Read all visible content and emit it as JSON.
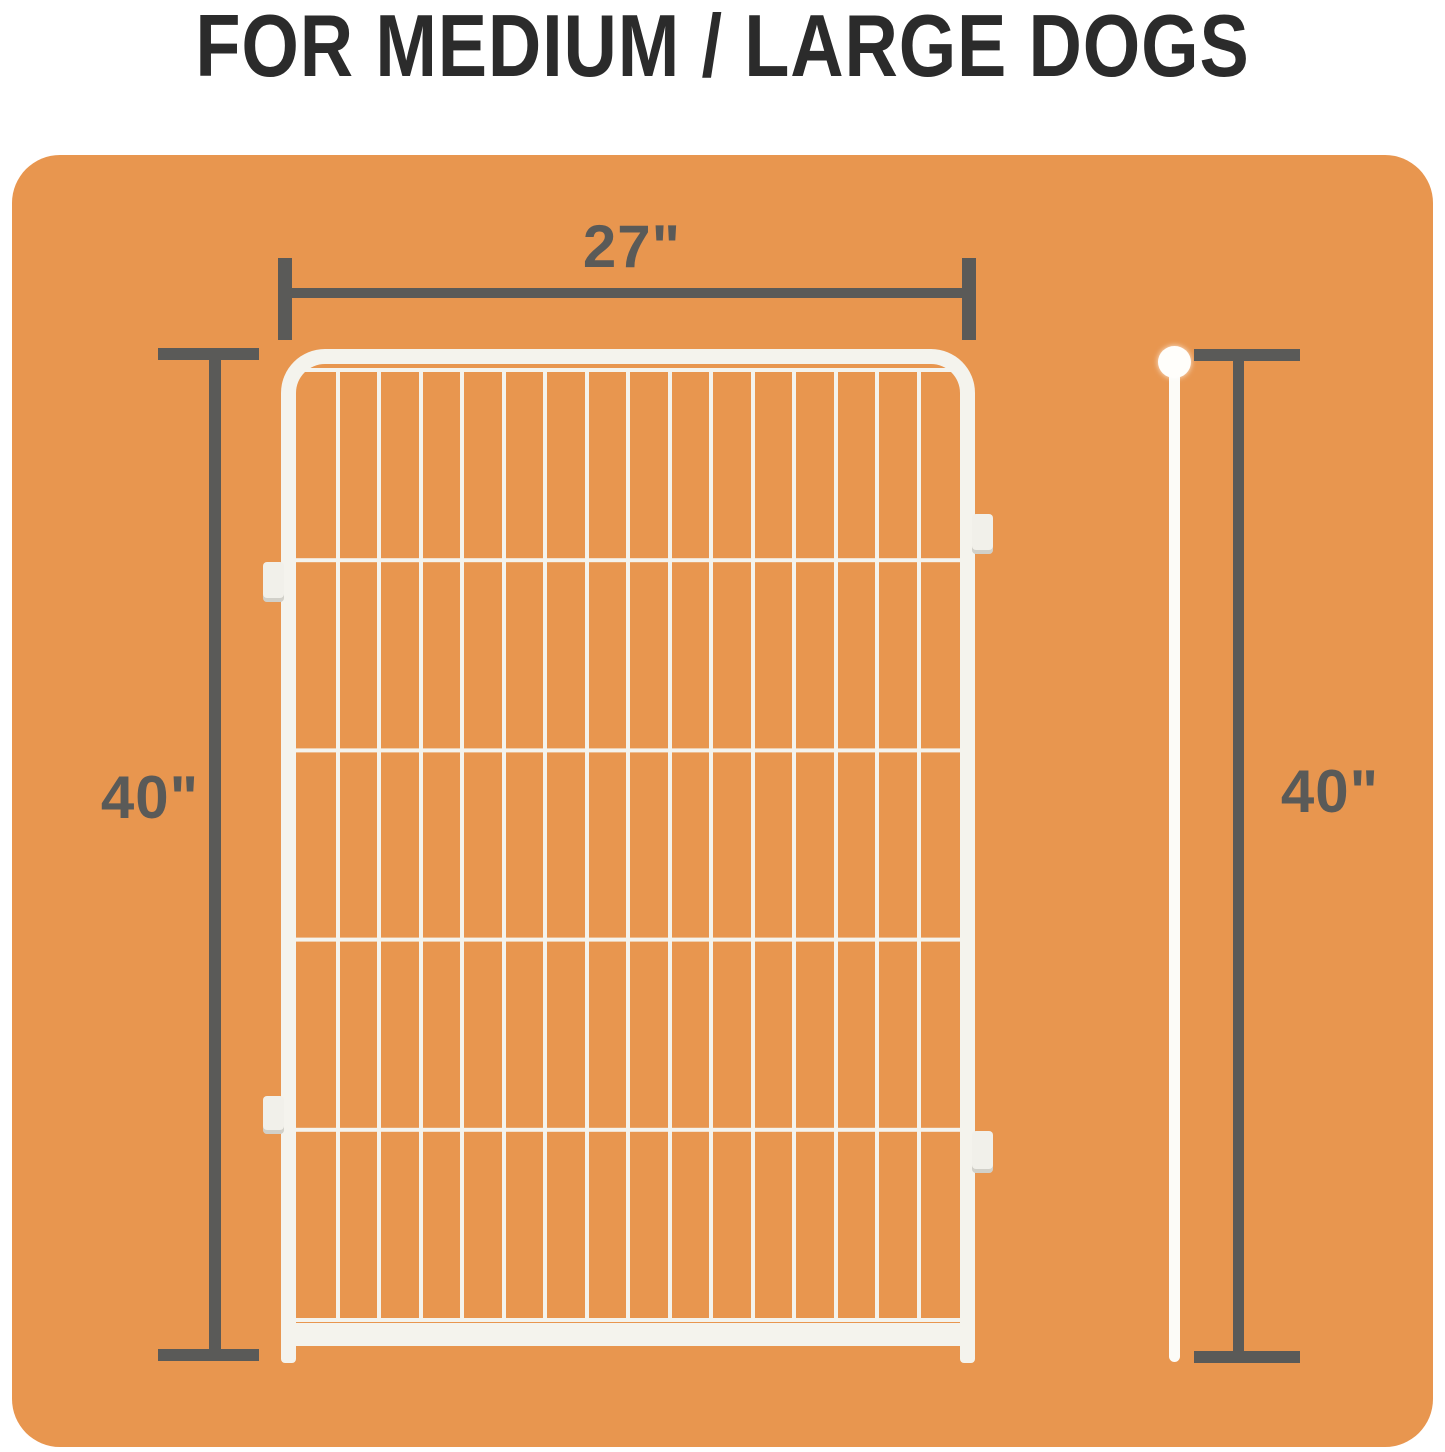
{
  "title": "FOR MEDIUM / LARGE DOGS",
  "colors": {
    "panel_orange": "#E8964F",
    "dimension_gray": "#5A5A58",
    "title_dark": "#2B2B2B",
    "fence_white": "#F4F3ED",
    "rod_white": "#FCFBF7",
    "tab_white": "#F1F0EA",
    "page_white": "#FFFFFF"
  },
  "measurements": {
    "width": {
      "label": "27\""
    },
    "height_left": {
      "label": "40\""
    },
    "height_right": {
      "label": "40\""
    }
  },
  "fence": {
    "vertical_wires": 15,
    "horizontal_sections": 5,
    "side_tabs": 4
  }
}
